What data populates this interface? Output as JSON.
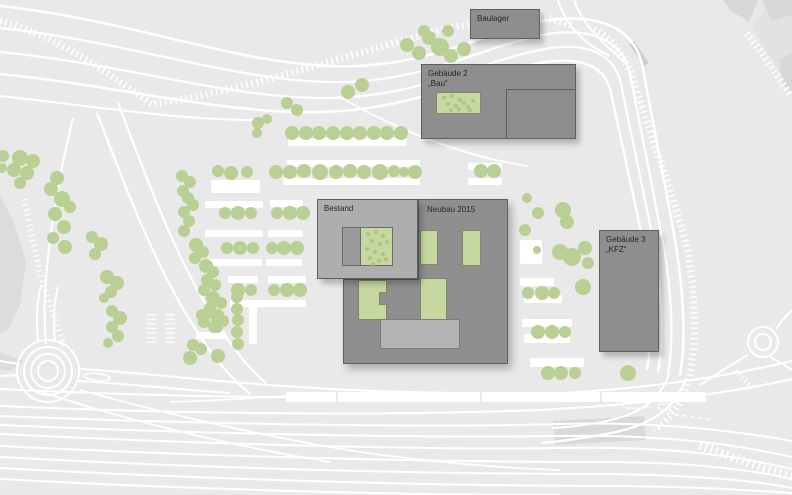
{
  "title": "Lageplan",
  "colors": {
    "background": "#e9e9e9",
    "road": "#ffffff",
    "tree": "#b9cf93",
    "building_dark": "#8e8e8e",
    "building_light": "#aeaeae",
    "building_annex": "#b5b5b5",
    "courtyard_green": "#c6d8a0",
    "courtyard_gray": "#9b9b9b",
    "ground_gray": "#d8d8d8",
    "label_text": "#262626"
  },
  "buildings": {
    "baulager": {
      "label": "Baulager"
    },
    "gebaeude2": {
      "line1": "Gebäude 2",
      "line2": "„Bau“"
    },
    "bestand": {
      "label": "Bestand"
    },
    "neubau": {
      "label": "Neubau 2015"
    },
    "gebaeude3": {
      "line1": "Gebäude 3",
      "line2": "„KFZ“"
    }
  },
  "map": {
    "ground": [
      {
        "points": "752,28 792,92 792,0 770,0",
        "fill": "#e2e2e2"
      },
      {
        "points": "723,0 758,0 749,22 731,11",
        "fill": "#d8d8d8"
      },
      {
        "points": "762,0 792,0 792,15 771,21",
        "fill": "#d8d8d8"
      },
      {
        "points": "779,60 792,53 792,92 783,85",
        "fill": "#d8d8d8"
      },
      {
        "points": "629,44 634,41 649,63 644,66",
        "fill": "#cdcdcd"
      },
      {
        "points": "0,196 14,222 26,262 20,305 8,330 0,334",
        "fill": "#dcdcdc"
      },
      {
        "points": "0,352 23,361 10,371 0,369",
        "fill": "#dcdcdc"
      },
      {
        "points": "553,421 644,416 646,440 555,445",
        "fill": "#d9d9d9"
      }
    ],
    "roads": [
      {
        "d": "M0,6 C130,20 230,62 330,66 C430,70 490,28 550,20 C603,13 634,31 642,64 C652,118 666,188 676,246 C684,298 686,340 680,376",
        "w": 2.5
      },
      {
        "d": "M0,28 C130,42 230,80 330,82 C426,84 486,44 548,34 C597,27 624,44 630,74 C640,126 654,194 664,248 C672,298 674,340 668,374",
        "w": 2.2
      },
      {
        "d": "M0,52 C125,64 225,98 325,98 C420,98 482,60 545,49 C590,41 615,56 621,84 C631,134 645,198 655,250 C662,298 664,338 658,372",
        "w": 2.2
      },
      {
        "d": "M0,74 C120,86 220,114 320,112 C415,110 478,74 540,63 C584,55 606,68 611,93 C621,140 635,202 645,252 C651,298 653,336 647,370",
        "w": 2.5
      },
      {
        "d": "M0,96 C100,107 180,120 255,120",
        "w": 2
      },
      {
        "d": "M558,0 C566,26 584,44 610,56",
        "w": 2
      },
      {
        "d": "M574,0 C582,24 600,40 624,62",
        "w": 2
      },
      {
        "d": "M118,103 C142,165 172,252 215,320 C231,346 247,367 266,383",
        "w": 2.2
      },
      {
        "d": "M97,113 C120,172 152,262 196,330 C212,356 230,377 250,394",
        "w": 2.2
      },
      {
        "d": "M73,118 C60,170 48,240 45,292 C44,316 45,332 46,344",
        "w": 2
      },
      {
        "d": "M338,96 C400,132 470,158 528,166",
        "w": 1.8
      },
      {
        "d": "M38,341 C36,320 37,300 41,285",
        "w": 2
      },
      {
        "d": "M55,341 C53,320 54,302 58,287",
        "w": 2
      },
      {
        "d": "M0,361 L19,364",
        "w": 2
      },
      {
        "d": "M0,376 L18,375",
        "w": 2
      },
      {
        "d": "M79,369 C120,371 170,377 232,382 C300,388 380,392 455,393",
        "w": 2
      },
      {
        "d": "M78,381 C120,383 170,389 230,393",
        "w": 2
      },
      {
        "d": "M170,402 C210,401 250,398 286,396",
        "w": 1.8
      },
      {
        "d": "M686,378 C676,408 652,424 616,432 C588,438 562,441 542,443",
        "w": 2.2
      },
      {
        "d": "M669,374 C661,398 641,413 611,420 C590,425 570,427 552,428",
        "w": 2
      },
      {
        "d": "M700,385 C720,371 736,362 748,355",
        "w": 2
      },
      {
        "d": "M770,357 C779,362 786,366 792,370",
        "w": 2
      },
      {
        "d": "M776,329 C781,321 787,315 792,310",
        "w": 2
      },
      {
        "d": "M0,389 C180,398 380,400 540,394 C640,390 720,378 792,361",
        "w": 2
      },
      {
        "d": "M0,406 C180,414 380,416 540,410 C650,404 730,393 792,379",
        "w": 2
      },
      {
        "d": "M0,416 C200,424 420,428 560,424 C660,421 742,432 792,441",
        "w": 2
      },
      {
        "d": "M0,425 C200,434 420,438 560,436 C672,434 742,446 792,457",
        "w": 2
      },
      {
        "d": "M0,434 C200,444 420,450 560,448 C680,446 746,458 792,469",
        "w": 2
      },
      {
        "d": "M0,446 C200,456 420,462 600,462 C700,462 762,472 792,479",
        "w": 2
      },
      {
        "d": "M0,457 C200,468 420,474 600,474 C706,475 762,482 792,488",
        "w": 2
      },
      {
        "d": "M0,468 C220,480 440,486 620,486 C708,487 762,491 792,493",
        "w": 2
      },
      {
        "d": "M0,479 C220,491 420,495 560,495",
        "w": 2
      },
      {
        "d": "M80,390 C160,412 260,436 360,452 C432,462 500,468 560,470",
        "w": 1.8
      },
      {
        "d": "M42,392 C120,418 220,444 330,462",
        "w": 1.8
      }
    ],
    "hatches": [
      {
        "d": "M0,21 C62,38 112,77 152,104 C240,92 330,60 430,33 C492,17 542,11 572,26",
        "w": 7,
        "dash": "1.6 3.6"
      },
      {
        "d": "M594,29 C618,42 630,66 638,94 C655,148 676,204 688,252 C696,300 697,340 689,378 C684,400 672,418 654,430",
        "w": 7,
        "dash": "1.6 3.6"
      },
      {
        "d": "M700,445 C732,458 764,468 792,477",
        "w": 9,
        "dash": "1.8 3.8"
      },
      {
        "d": "M747,33 C762,53 776,73 790,95",
        "w": 7,
        "dash": "1.6 3.6"
      },
      {
        "d": "M736,370 C742,378 748,384 754,389",
        "w": 5,
        "dash": "1.4 3.2"
      },
      {
        "d": "M25,199 C33,251 47,301 65,347",
        "w": 6,
        "dash": "1.3 3.9"
      },
      {
        "d": "M151,314 L151,345",
        "w": 10,
        "dash": "1.2 3.4"
      },
      {
        "d": "M170,314 L170,345",
        "w": 10,
        "dash": "1.2 3.4"
      }
    ],
    "circles": [
      {
        "cx": 48,
        "cy": 371,
        "r": 10
      },
      {
        "cx": 48,
        "cy": 371,
        "r": 17
      },
      {
        "cx": 48,
        "cy": 371,
        "r": 24
      },
      {
        "cx": 48,
        "cy": 371,
        "r": 31
      },
      {
        "cx": 763,
        "cy": 342,
        "r": 8
      },
      {
        "cx": 763,
        "cy": 342,
        "r": 15
      }
    ],
    "ellipses": [
      {
        "cx": 97,
        "cy": 377,
        "rx": 13,
        "ry": 3.5,
        "rot": 6
      }
    ],
    "capsules": [
      {
        "x": 623,
        "y": 402,
        "w": 25,
        "h": 6
      },
      {
        "x": 658,
        "y": 404,
        "w": 13,
        "h": 6
      }
    ],
    "dashed": [
      {
        "d": "M667,413 C684,416 700,418 714,420",
        "w": 1.5,
        "dash": "4 4"
      }
    ],
    "strips": [
      [
        288,
        138,
        119,
        8
      ],
      [
        287,
        160,
        133,
        7
      ],
      [
        283,
        178,
        137,
        7
      ],
      [
        468,
        163,
        34,
        7
      ],
      [
        468,
        178,
        34,
        7
      ],
      [
        211,
        180,
        49,
        13
      ],
      [
        205,
        201,
        58,
        7
      ],
      [
        270,
        200,
        33,
        7
      ],
      [
        205,
        230,
        58,
        7
      ],
      [
        268,
        230,
        35,
        7
      ],
      [
        207,
        259,
        55,
        7
      ],
      [
        266,
        259,
        36,
        7
      ],
      [
        228,
        276,
        30,
        7
      ],
      [
        268,
        276,
        38,
        7
      ],
      [
        230,
        300,
        40,
        7
      ],
      [
        268,
        300,
        38,
        7
      ],
      [
        196,
        332,
        30,
        7
      ],
      [
        249,
        306,
        8,
        38
      ],
      [
        520,
        240,
        22,
        24
      ],
      [
        520,
        278,
        34,
        8
      ],
      [
        524,
        295,
        38,
        8
      ],
      [
        522,
        319,
        50,
        8
      ],
      [
        524,
        334,
        46,
        9
      ],
      [
        530,
        358,
        54,
        9
      ],
      [
        286,
        392,
        420,
        10
      ]
    ],
    "strip_dividers": [
      [
        336,
        392,
        2,
        10
      ],
      [
        480,
        392,
        2,
        10
      ],
      [
        600,
        392,
        2,
        10
      ]
    ],
    "trees": [
      [
        407,
        45,
        7
      ],
      [
        419,
        53,
        7
      ],
      [
        429,
        38,
        7
      ],
      [
        440,
        47,
        9
      ],
      [
        451,
        56,
        7
      ],
      [
        448,
        31,
        6
      ],
      [
        464,
        49,
        7
      ],
      [
        424,
        31,
        6
      ],
      [
        348,
        92,
        7
      ],
      [
        362,
        85,
        7
      ],
      [
        287,
        103,
        6
      ],
      [
        297,
        110,
        6
      ],
      [
        258,
        123,
        6
      ],
      [
        267,
        119,
        5
      ],
      [
        257,
        133,
        5
      ],
      [
        481,
        171,
        7
      ],
      [
        494,
        171,
        7
      ],
      [
        292,
        133,
        7
      ],
      [
        306,
        133,
        7
      ],
      [
        319,
        133,
        7
      ],
      [
        333,
        133,
        7
      ],
      [
        347,
        133,
        7
      ],
      [
        360,
        133,
        7
      ],
      [
        374,
        133,
        7
      ],
      [
        387,
        133,
        7
      ],
      [
        401,
        133,
        7
      ],
      [
        276,
        172,
        7
      ],
      [
        290,
        172,
        7
      ],
      [
        304,
        171,
        7
      ],
      [
        320,
        172,
        8
      ],
      [
        336,
        172,
        7
      ],
      [
        350,
        171,
        7
      ],
      [
        364,
        172,
        7
      ],
      [
        380,
        172,
        8
      ],
      [
        394,
        171,
        6
      ],
      [
        404,
        172,
        5
      ],
      [
        415,
        172,
        7
      ],
      [
        218,
        171,
        6
      ],
      [
        231,
        173,
        7
      ],
      [
        247,
        172,
        6
      ],
      [
        225,
        213,
        6
      ],
      [
        238,
        213,
        7
      ],
      [
        251,
        213,
        6
      ],
      [
        277,
        213,
        6
      ],
      [
        290,
        213,
        7
      ],
      [
        303,
        213,
        7
      ],
      [
        227,
        248,
        6
      ],
      [
        240,
        248,
        7
      ],
      [
        253,
        248,
        6
      ],
      [
        272,
        248,
        6
      ],
      [
        284,
        248,
        7
      ],
      [
        297,
        248,
        7
      ],
      [
        238,
        290,
        7
      ],
      [
        251,
        290,
        6
      ],
      [
        274,
        290,
        6
      ],
      [
        287,
        290,
        7
      ],
      [
        300,
        290,
        7
      ],
      [
        204,
        322,
        6
      ],
      [
        217,
        322,
        6
      ],
      [
        182,
        176,
        6
      ],
      [
        190,
        182,
        6
      ],
      [
        183,
        191,
        6
      ],
      [
        188,
        198,
        6
      ],
      [
        193,
        205,
        6
      ],
      [
        184,
        212,
        6
      ],
      [
        189,
        221,
        6
      ],
      [
        184,
        231,
        6
      ],
      [
        196,
        245,
        7
      ],
      [
        203,
        252,
        6
      ],
      [
        195,
        258,
        6
      ],
      [
        206,
        266,
        7
      ],
      [
        213,
        272,
        6
      ],
      [
        207,
        280,
        6
      ],
      [
        215,
        285,
        6
      ],
      [
        204,
        290,
        6
      ],
      [
        213,
        298,
        7
      ],
      [
        221,
        303,
        6
      ],
      [
        210,
        308,
        6
      ],
      [
        218,
        315,
        6
      ],
      [
        223,
        321,
        6
      ],
      [
        214,
        327,
        6
      ],
      [
        202,
        315,
        6
      ],
      [
        212,
        313,
        6
      ],
      [
        217,
        327,
        6
      ],
      [
        193,
        345,
        6
      ],
      [
        201,
        349,
        6
      ],
      [
        190,
        358,
        7
      ],
      [
        218,
        356,
        7
      ],
      [
        237,
        297,
        6
      ],
      [
        237,
        309,
        6
      ],
      [
        238,
        320,
        6
      ],
      [
        237,
        332,
        6
      ],
      [
        238,
        344,
        6
      ],
      [
        20,
        158,
        8
      ],
      [
        33,
        161,
        7
      ],
      [
        14,
        170,
        7
      ],
      [
        27,
        173,
        7
      ],
      [
        20,
        183,
        6
      ],
      [
        3,
        156,
        6
      ],
      [
        2,
        168,
        5
      ],
      [
        57,
        178,
        7
      ],
      [
        51,
        189,
        7
      ],
      [
        62,
        199,
        8
      ],
      [
        70,
        207,
        6
      ],
      [
        55,
        214,
        7
      ],
      [
        64,
        227,
        7
      ],
      [
        53,
        238,
        6
      ],
      [
        65,
        247,
        7
      ],
      [
        92,
        237,
        6
      ],
      [
        101,
        244,
        7
      ],
      [
        95,
        254,
        6
      ],
      [
        107,
        277,
        7
      ],
      [
        117,
        283,
        7
      ],
      [
        111,
        292,
        6
      ],
      [
        104,
        298,
        5
      ],
      [
        112,
        311,
        6
      ],
      [
        120,
        318,
        7
      ],
      [
        112,
        327,
        6
      ],
      [
        118,
        336,
        6
      ],
      [
        108,
        343,
        5
      ],
      [
        527,
        198,
        5
      ],
      [
        538,
        213,
        6
      ],
      [
        563,
        210,
        8
      ],
      [
        567,
        222,
        7
      ],
      [
        525,
        230,
        6
      ],
      [
        537,
        250,
        4
      ],
      [
        560,
        252,
        8
      ],
      [
        572,
        257,
        9
      ],
      [
        585,
        248,
        7
      ],
      [
        588,
        263,
        6
      ],
      [
        583,
        287,
        8
      ],
      [
        528,
        293,
        6
      ],
      [
        542,
        293,
        7
      ],
      [
        554,
        293,
        6
      ],
      [
        538,
        332,
        7
      ],
      [
        552,
        332,
        7
      ],
      [
        565,
        332,
        6
      ],
      [
        548,
        373,
        7
      ],
      [
        561,
        373,
        7
      ],
      [
        575,
        373,
        6
      ],
      [
        628,
        373,
        8
      ]
    ],
    "bestand_dots": [
      [
        5,
        4
      ],
      [
        13,
        2
      ],
      [
        20,
        6
      ],
      [
        9,
        11
      ],
      [
        17,
        14
      ],
      [
        24,
        12
      ],
      [
        4,
        19
      ],
      [
        12,
        22
      ],
      [
        20,
        24
      ],
      [
        7,
        28
      ],
      [
        16,
        31
      ],
      [
        23,
        29
      ],
      [
        10,
        34
      ]
    ],
    "geb2_dots": [
      [
        5,
        3
      ],
      [
        13,
        1
      ],
      [
        21,
        5
      ],
      [
        9,
        9
      ],
      [
        17,
        11
      ],
      [
        25,
        8
      ],
      [
        12,
        15
      ],
      [
        20,
        14
      ],
      [
        29,
        12
      ],
      [
        34,
        6
      ],
      [
        31,
        15
      ]
    ]
  }
}
